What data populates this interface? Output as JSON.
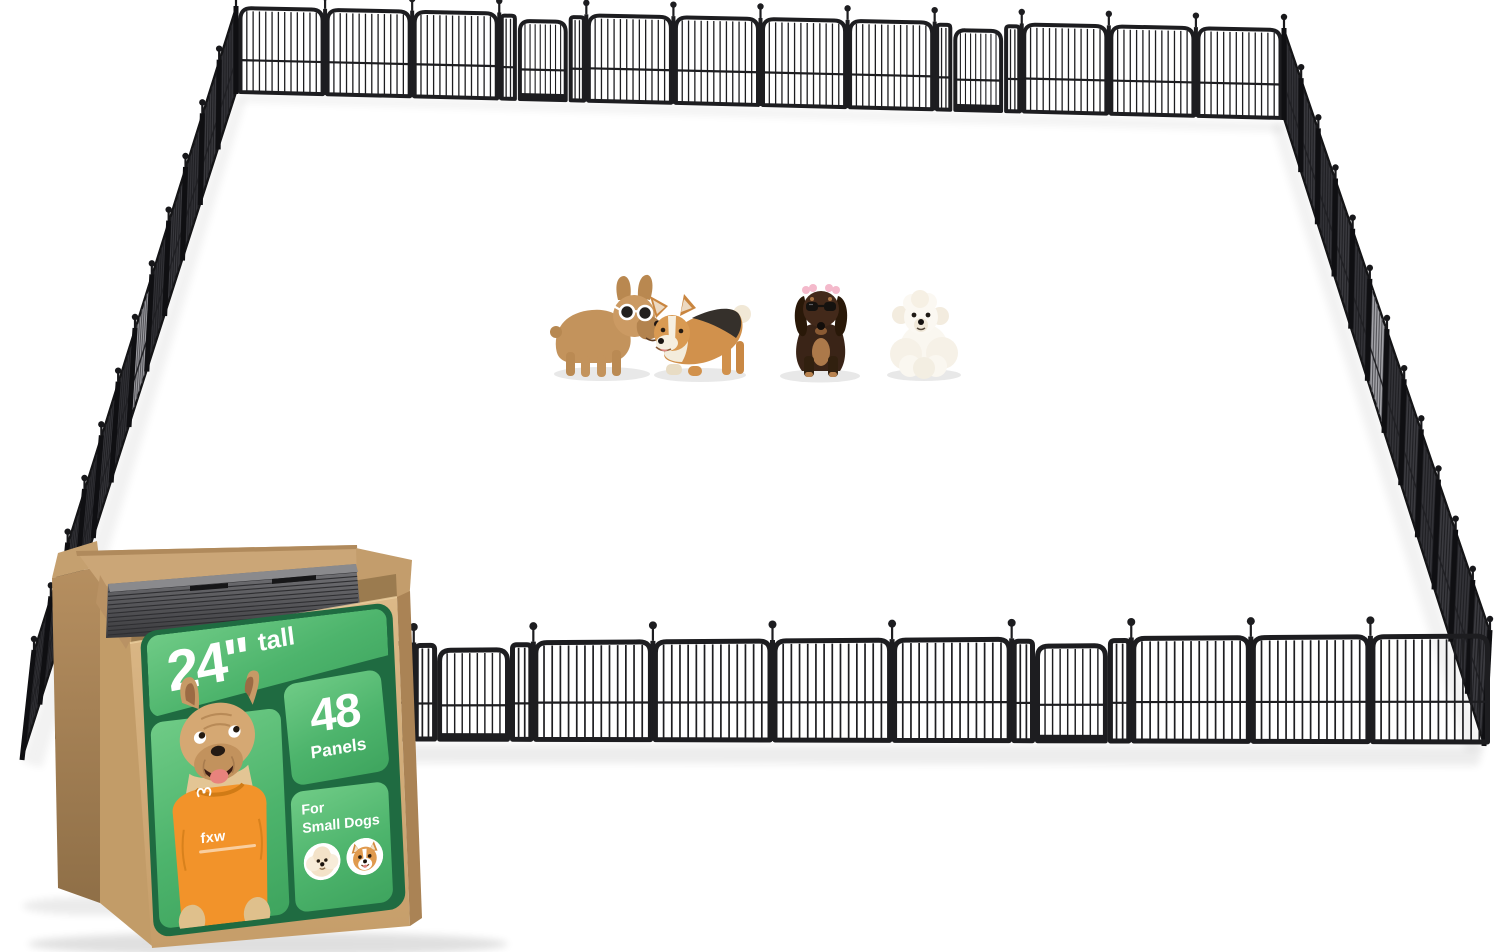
{
  "product": {
    "brand": "fxw",
    "height_value": "24\"",
    "height_suffix": "tall",
    "panel_count": "48",
    "panel_label": "Panels",
    "audience_line1": "For",
    "audience_line2": "Small Dogs"
  },
  "box": {
    "kraft_color": "#cfa873",
    "kraft_dark": "#a9835a",
    "label_bg": "#1f6b41",
    "section_green_light": "#6fcb86",
    "section_green": "#3ea45e",
    "text_color": "#ffffff",
    "shirt_color": "#f2932a",
    "contents_note": "stack of black metal fence panels visible in open carton"
  },
  "fence": {
    "frame_color": "#1d1d20",
    "side_panel_color_a": "#3a3a3f",
    "side_panel_color_b": "#333338",
    "side_panel_door_color": "#a3a3a8",
    "side_bar_color": "#202024",
    "walls": {
      "back": {
        "units": [
          "panel",
          "panel",
          "panel",
          "door",
          "panel",
          "panel",
          "panel",
          "panel",
          "door",
          "panel",
          "panel",
          "panel"
        ]
      },
      "front": {
        "units": [
          "panel",
          "panel",
          "panel",
          "door",
          "panel",
          "panel",
          "panel",
          "panel",
          "door",
          "panel",
          "panel",
          "panel"
        ]
      },
      "left": {
        "panels": 12,
        "door_index": 5
      },
      "right": {
        "panels": 12,
        "door_index": 5
      }
    }
  },
  "dogs": [
    {
      "name": "french-bulldog",
      "coat": "tan",
      "accessory": "white sunglasses"
    },
    {
      "name": "corgi",
      "coat": "tan-black-white",
      "accessory": ""
    },
    {
      "name": "dachshund",
      "coat": "dark brown",
      "accessory": "sunglasses and pink hair bows"
    },
    {
      "name": "bichon",
      "coat": "white",
      "accessory": ""
    }
  ]
}
